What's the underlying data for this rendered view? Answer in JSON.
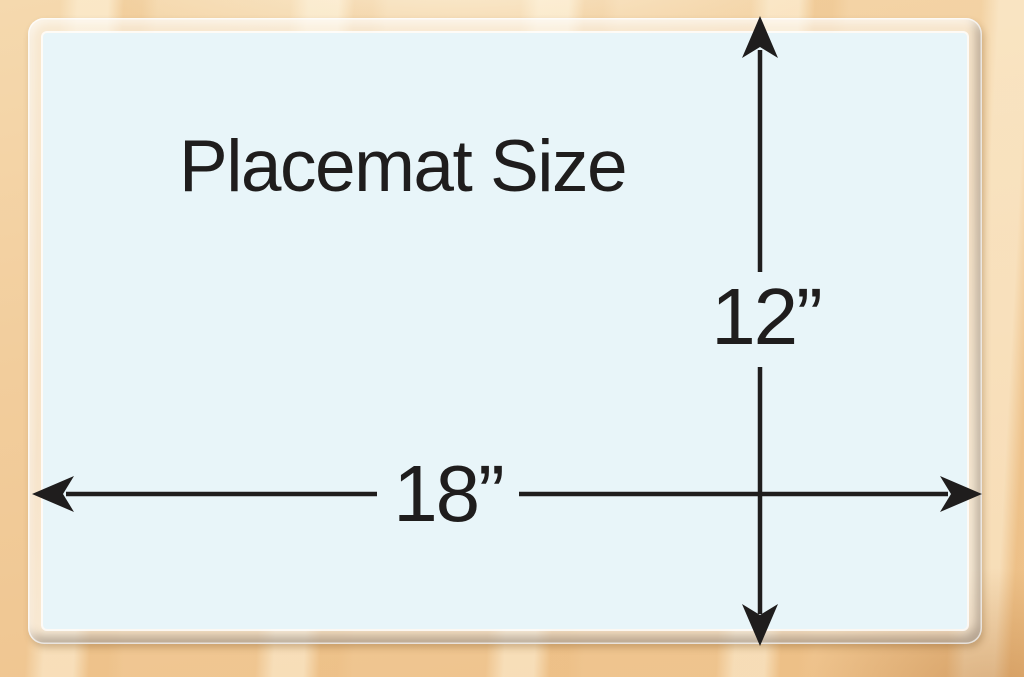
{
  "title": "Placemat Size",
  "dimensions": {
    "height": {
      "label": "12”",
      "inches": 12
    },
    "width": {
      "label": "18”",
      "inches": 18
    }
  },
  "colors": {
    "mat_surface": "#e8f5f9",
    "ink": "#1f1d1d",
    "wood_light": "#f5d9ae",
    "wood_dark": "#eec28b",
    "laminate_edge": "#f7ebd8"
  }
}
